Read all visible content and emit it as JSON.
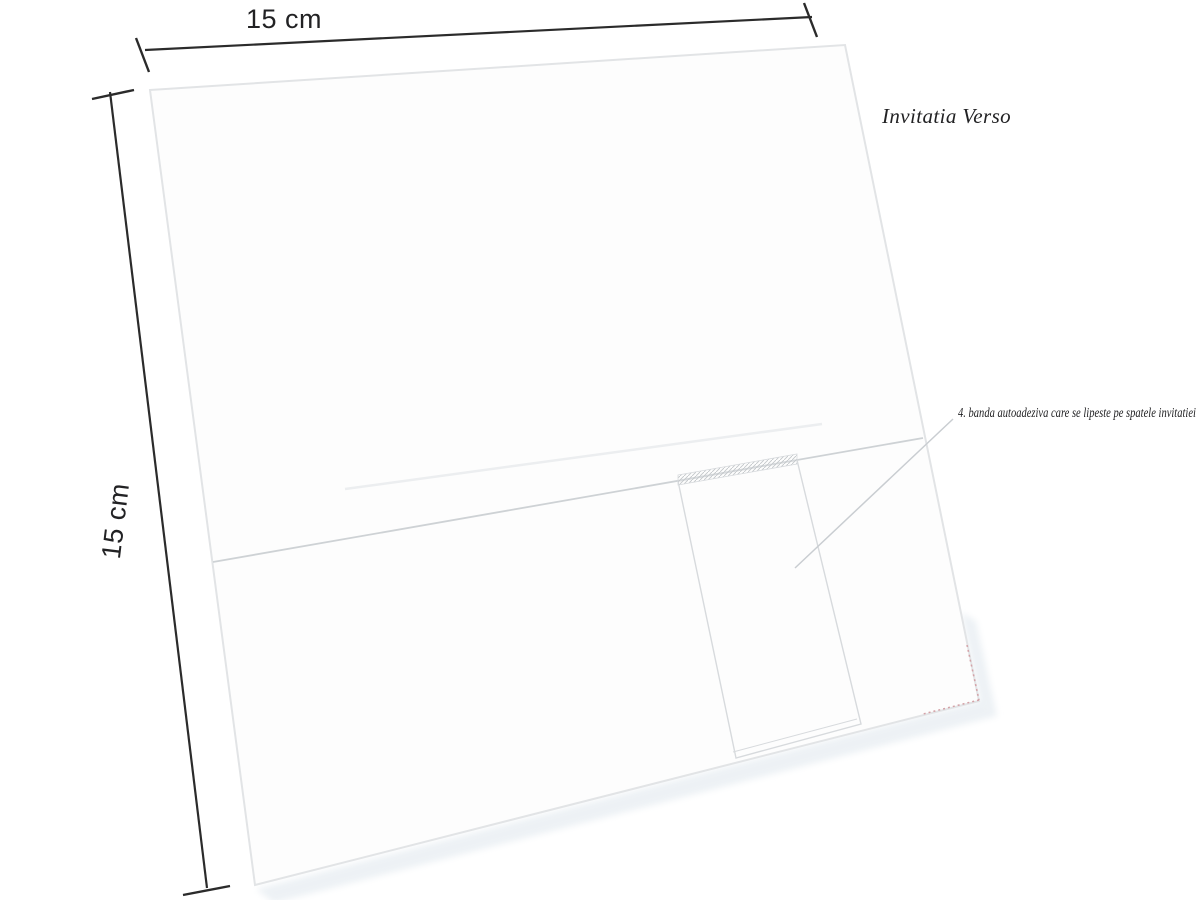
{
  "diagram": {
    "title": "Invitatia Verso",
    "top_dimension_label": "15 cm",
    "left_dimension_label": "15 cm",
    "annotation": "4. banda autoadeziva care se lipeste pe spatele invitatiei"
  },
  "colors": {
    "background": "#ffffff",
    "text": "#222224",
    "dimension": "#2b2b2b",
    "card_edge": "#e2e4e6",
    "card_fill": "#fdfdfd",
    "fold_line": "#ced2d5",
    "crease_line": "#eceef0",
    "band_edge": "#d7dadd",
    "hatch": "#c3c7ca",
    "leader": "#c9cdd1",
    "trim_mark": "#d4a2a7",
    "shadow": "#e7edf2"
  }
}
